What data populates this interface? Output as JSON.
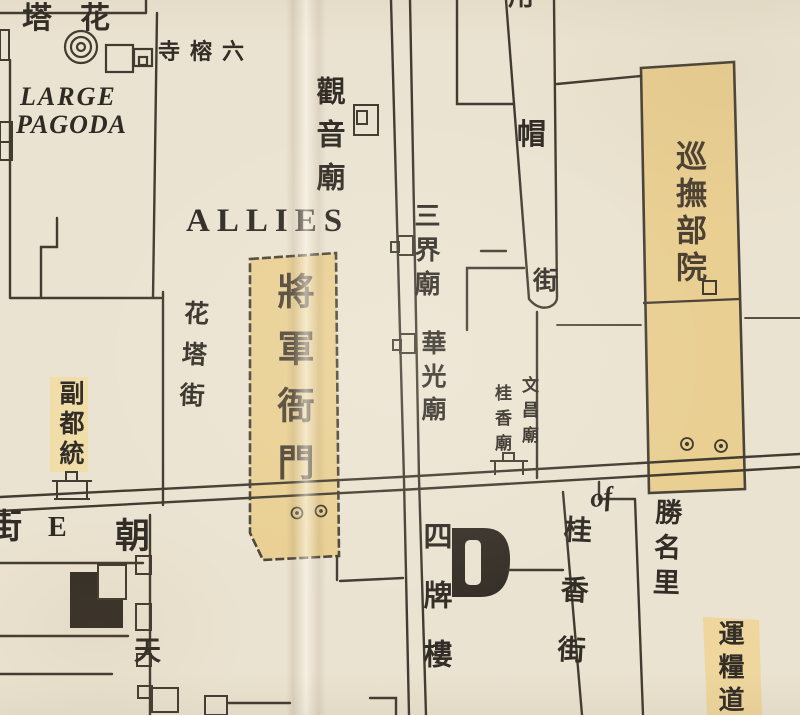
{
  "map": {
    "labels": {
      "large_pagoda_cn": "花塔",
      "large_pagoda_en_line1": "LARGE",
      "large_pagoda_en_line2": "PAGODA",
      "six_banyan_temple": "六榕寺",
      "guanyin_temple": "觀音廟",
      "allies": "ALLIES",
      "flower_pagoda_street": "花塔街",
      "general_yamen": "將軍衙門",
      "deputy_lieutenant_general": "副都統",
      "sanjie_temple": "三界廟",
      "huaguang_temple": "華光廟",
      "wenchang_temple": "文昌廟",
      "guixiang_temple": "桂香廟",
      "governor_yamen": "巡撫部院",
      "hat_street_top_char": "用",
      "hat_street_mid_char": "帽",
      "hat_street_bottom_char": "街",
      "street_e_char": "街",
      "street_e_letter": "E",
      "chaotian_street_char1": "朝",
      "chaotian_street_char2": "天",
      "four_pailou": "四牌樓",
      "guixiang_street": "桂香街",
      "shengming_li": "勝名里",
      "of_annotation": "of",
      "grain_transport_circuit": "運糧道"
    },
    "colors": {
      "paper": "#ebe3d1",
      "ink": "#423b30",
      "text_ink": "#322d26",
      "highlight": "#e9cf92",
      "highlight_soft": "#f0dda8"
    }
  }
}
